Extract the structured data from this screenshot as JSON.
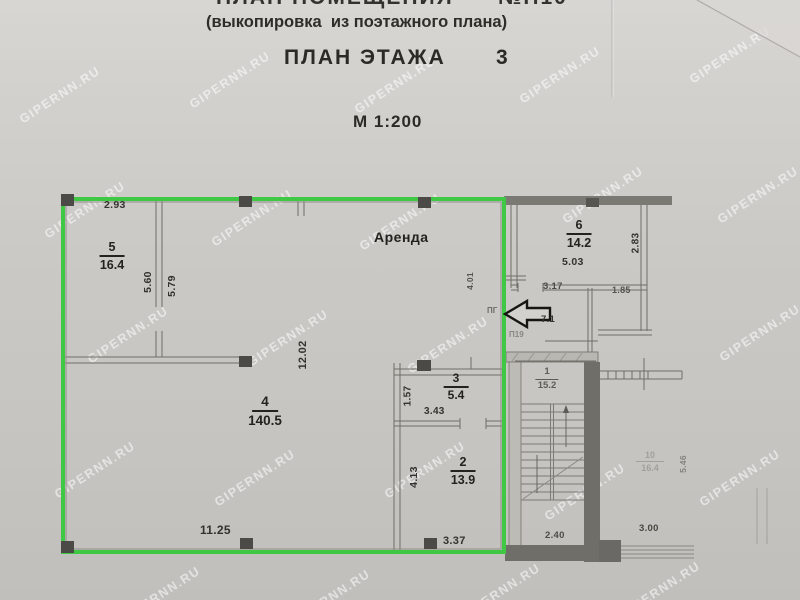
{
  "header": {
    "line1": "ПЛАН ПОМЕЩЕНИЯ",
    "line1_number": "№П10",
    "line2": "(выкопировка  из поэтажного плана)",
    "title": "ПЛАН ЭТАЖА",
    "floor_number": "3",
    "scale": "М 1:200"
  },
  "watermark": {
    "text": "GIPERNN.RU"
  },
  "plan": {
    "rental_label": "Аренда",
    "rooms": {
      "r5": {
        "num": "5",
        "area": "16.4"
      },
      "r4": {
        "num": "4",
        "area": "140.5"
      },
      "r3": {
        "num": "3",
        "area": "5.4"
      },
      "r2": {
        "num": "2",
        "area": "13.9"
      },
      "r6": {
        "num": "6",
        "area": "14.2"
      },
      "r1": {
        "num": "1",
        "area": "15.2"
      },
      "r10": {
        "num": "10",
        "area": "16.4"
      }
    },
    "dims": {
      "d293": "2.93",
      "d560": "5.60",
      "d579": "5.79",
      "d1202": "12.02",
      "d1125": "11.25",
      "d337": "3.37",
      "d157": "1.57",
      "d343": "3.43",
      "d413": "4.13",
      "d401": "4.01",
      "d503": "5.03",
      "d283": "2.83",
      "d317": "3.17",
      "d185": "1.85",
      "d71": "7.1",
      "d240": "2.40",
      "d300": "3.00",
      "d546": "5.46"
    },
    "notes": {
      "pg": "ПГ",
      "p19": "П19"
    },
    "colors": {
      "highlight": "#3ec843",
      "wall": "#77756f",
      "ink": "#2c2b28"
    }
  }
}
